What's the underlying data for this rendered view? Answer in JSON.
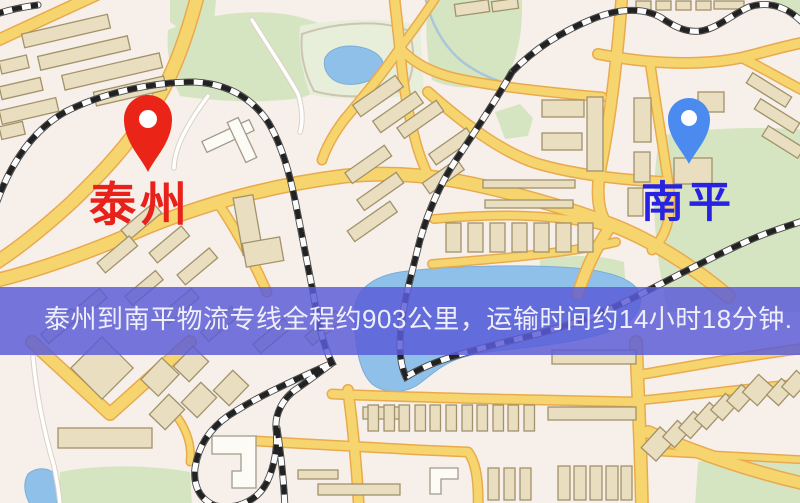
{
  "map": {
    "origin": {
      "name": "泰州",
      "label_color": "#e8211a",
      "pin_color": "#ea2517"
    },
    "destination": {
      "name": "南平",
      "label_color": "#2823e2",
      "pin_color": "#4b8bf0"
    },
    "banner": {
      "text": "泰州到南平物流专线全程约903公里，运输时间约14小时18分钟.",
      "distance": "约903公里",
      "duration": "约14小时18分钟",
      "text_color": "#efeefb",
      "background_color": "#5a5cd8"
    }
  },
  "colors": {
    "background": "#f7f0ea",
    "green": "#d6e5c1",
    "green_light": "#e7efdb",
    "water": "#8fc0ea",
    "road": "#f6d56e",
    "road_casing": "#e9aa4e",
    "building": "#e9dec0",
    "railway": "#222222"
  }
}
